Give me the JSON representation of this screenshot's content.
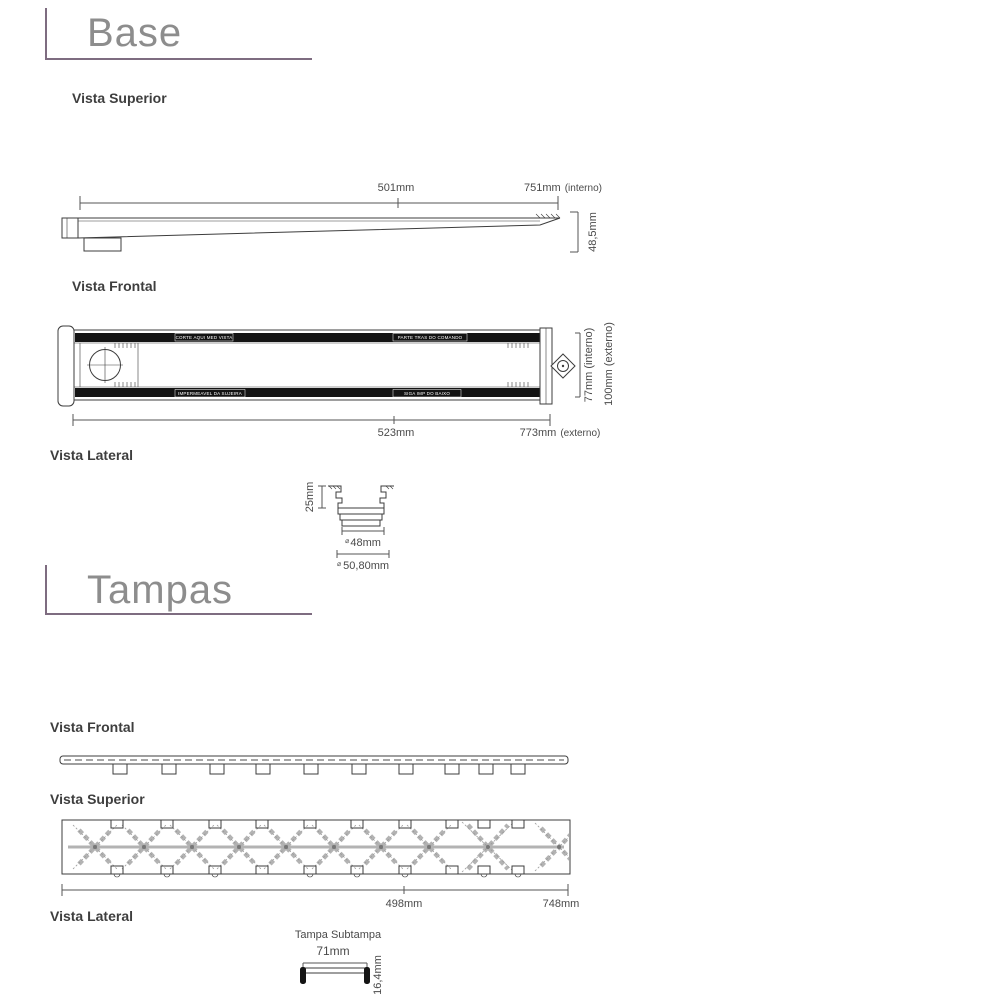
{
  "colors": {
    "accent_purple": "#7e6c80",
    "title_gray": "#8d8d8d",
    "heading_dark": "#3e3e3e",
    "line_dark": "#3c3c3c",
    "bar_black": "#141414",
    "pattern_gray": "#b3b3b3"
  },
  "base": {
    "title": "Base",
    "superior": {
      "label": "Vista Superior",
      "dim_501": "501mm",
      "dim_751": "751mm",
      "dim_751_suffix": "(interno)",
      "dim_height": "48,5mm"
    },
    "frontal": {
      "label": "Vista Frontal",
      "etch_top_left": "CORTE AQUI MED VISTA",
      "etch_top_right": "PARTE TRAS DO COMANDO",
      "etch_bottom_left": "IMPERMEAVEL DA SUJEIRA",
      "etch_bottom_right": "SIGA IMP DO BAIXO",
      "dim_interno": "77mm  (interno)",
      "dim_externo": "100mm (externo)",
      "dim_523": "523mm",
      "dim_773": "773mm",
      "dim_773_suffix": "(externo)"
    },
    "lateral": {
      "label": "Vista Lateral",
      "dim_25": "25mm",
      "diam": "⌀",
      "dim_48": "48mm",
      "dim_5080": "50,80mm"
    }
  },
  "tampas": {
    "title": "Tampas",
    "frontal": {
      "label": "Vista Frontal"
    },
    "superior": {
      "label": "Vista Superior",
      "dim_498": "498mm",
      "dim_748": "748mm"
    },
    "lateral": {
      "label": "Vista Lateral",
      "caption": "Tampa Subtampa",
      "dim_71": "71mm",
      "dim_164": "16,4mm"
    }
  }
}
